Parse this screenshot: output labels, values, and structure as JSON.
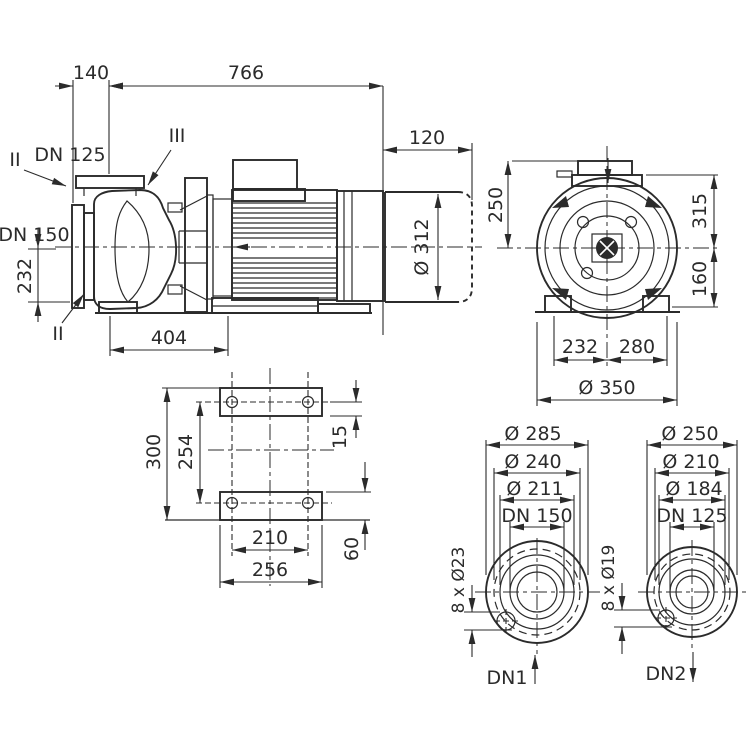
{
  "style": {
    "background": "#ffffff",
    "line_color": "#2b2b2b"
  },
  "views": {
    "side": {
      "dim_140": "140",
      "dim_766": "766",
      "dim_120": "120",
      "dim_dia_312": "Ø 312",
      "dim_404": "404",
      "dim_232": "232",
      "label_dn125": "DN 125",
      "label_dn150": "DN 150",
      "label_section_ii_top": "II",
      "label_section_ii_bottom": "II",
      "label_section_iii": "III"
    },
    "end": {
      "dim_250": "250",
      "dim_315": "315",
      "dim_160": "160",
      "dim_232": "232",
      "dim_280": "280",
      "dim_dia_350": "Ø 350"
    },
    "base": {
      "dim_300": "300",
      "dim_254": "254",
      "dim_15": "15",
      "dim_60": "60",
      "dim_210": "210",
      "dim_256": "256"
    },
    "flange_dn1": {
      "dim_dia_outer": "Ø 285",
      "dim_dia_bolt_circle": "Ø 240",
      "dim_dia_face": "Ø 211",
      "dim_dn": "DN 150",
      "dim_bolts": "8 x Ø23",
      "label_port": "DN1"
    },
    "flange_dn2": {
      "dim_dia_outer": "Ø 250",
      "dim_dia_bolt_circle": "Ø 210",
      "dim_dia_face": "Ø 184",
      "dim_dn": "DN 125",
      "dim_bolts": "8 x Ø19",
      "label_port": "DN2"
    }
  }
}
